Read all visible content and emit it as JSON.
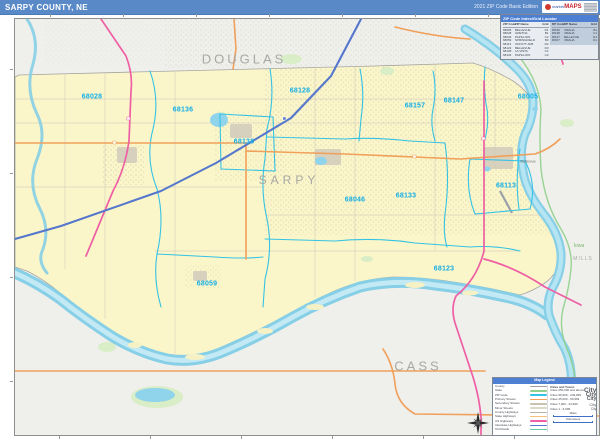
{
  "header": {
    "title": "SARPY COUNTY, NE",
    "edition": "2021 ZIP Code Basic Edition",
    "logo_prefix": "market",
    "logo_text": "MAPS"
  },
  "colors": {
    "header_blue": "#5a89c8",
    "county_yellow": "#fbf6c9",
    "outside_gray": "#efefec",
    "water_blue": "#86cfe6",
    "zip_line_cyan": "#35c2e5",
    "zip_label_cyan": "#14aee6",
    "road_orange": "#f0a05a",
    "road_pink": "#ee5fa4",
    "interstate_blue": "#5577cc",
    "state_green": "#8fd08a",
    "label_gray": "#a8a8a4"
  },
  "map": {
    "county_label": "SARPY",
    "zip_labels": [
      {
        "code": "68028",
        "x": 91,
        "y": 96
      },
      {
        "code": "68136",
        "x": 182,
        "y": 109
      },
      {
        "code": "68138",
        "x": 243,
        "y": 141
      },
      {
        "code": "68128",
        "x": 299,
        "y": 90
      },
      {
        "code": "68157",
        "x": 414,
        "y": 105
      },
      {
        "code": "68147",
        "x": 453,
        "y": 100
      },
      {
        "code": "68005",
        "x": 527,
        "y": 96
      },
      {
        "code": "68046",
        "x": 354,
        "y": 199
      },
      {
        "code": "68133",
        "x": 405,
        "y": 195
      },
      {
        "code": "68113",
        "x": 505,
        "y": 185
      },
      {
        "code": "68123",
        "x": 443,
        "y": 268
      },
      {
        "code": "68059",
        "x": 206,
        "y": 283
      }
    ],
    "neighbor_labels": [
      {
        "text": "DOUGLAS",
        "x": 243,
        "y": 58,
        "cls": ""
      },
      {
        "text": "SARPY",
        "x": 288,
        "y": 179,
        "cls": "mid"
      },
      {
        "text": "CASS",
        "x": 417,
        "y": 365,
        "cls": ""
      },
      {
        "text": "MILLS",
        "x": 582,
        "y": 258,
        "cls": "small"
      },
      {
        "text": "Iowa",
        "x": 578,
        "y": 245,
        "cls": "state"
      }
    ],
    "town_labels": [
      {
        "text": "Bellevue",
        "x": 527,
        "y": 160
      }
    ]
  },
  "zip_table": {
    "title": "ZIP Code Index/Grid Locator",
    "columns": [
      "ZIP Code",
      "ZIP Name",
      "Grid"
    ],
    "rows_left": [
      [
        "68005",
        "BELLEVUE",
        "D1"
      ],
      [
        "68028",
        "GRETNA",
        "B1"
      ],
      [
        "68046",
        "PAPILLION",
        "C2"
      ],
      [
        "68059",
        "SPRINGFIELD",
        "B3"
      ],
      [
        "68113",
        "OFFUTT AFB",
        "D2"
      ],
      [
        "68123",
        "BELLEVUE",
        "D3"
      ],
      [
        "68128",
        "LA VISTA",
        "C1"
      ],
      [
        "68133",
        "PAPILLION",
        "C2"
      ]
    ],
    "rows_right": [
      [
        "68136",
        "OMAHA",
        "B1"
      ],
      [
        "68138",
        "OMAHA",
        "C1"
      ],
      [
        "68147",
        "BELLEVUE",
        "D1"
      ],
      [
        "68157",
        "OMAHA",
        "D1"
      ]
    ]
  },
  "legend": {
    "title": "Map Legend",
    "line_items": [
      {
        "label": "County",
        "color": "#a0a0a0"
      },
      {
        "label": "State",
        "color": "#8fd08a"
      },
      {
        "label": "ZIP Code",
        "color": "#35c2e5"
      },
      {
        "label": "Primary Streets",
        "color": "#f0a05a"
      },
      {
        "label": "Secondary Streets",
        "color": "#c9c2b0"
      },
      {
        "label": "Minor Streets",
        "color": "#ddd8c8"
      },
      {
        "label": "County Highways",
        "color": "#b8b2a2"
      },
      {
        "label": "State Highways",
        "color": "#f5c079"
      },
      {
        "label": "US Highways",
        "color": "#ee5fa4"
      },
      {
        "label": "Interstate Highways",
        "color": "#5577cc"
      },
      {
        "label": "Toll Roads",
        "color": "#62c9a8"
      }
    ],
    "cities_title": "Cities and Towns",
    "city_sample": "City",
    "city_items": [
      {
        "label": "Cities 250,000 and above",
        "size": 6.5,
        "weight": "bold"
      },
      {
        "label": "Cities 99,999 - 249,999",
        "size": 5.5,
        "weight": "bold"
      },
      {
        "label": "Cities 25,000 - 99,999",
        "size": 5,
        "weight": "bold"
      },
      {
        "label": "Cities 7,000 - 24,999",
        "size": 4,
        "weight": "normal"
      },
      {
        "label": "Cities 1 - 6,999",
        "size": 3.2,
        "weight": "normal"
      }
    ],
    "scale_miles_label": "Miles",
    "scale_km_label": "Kilometers"
  }
}
